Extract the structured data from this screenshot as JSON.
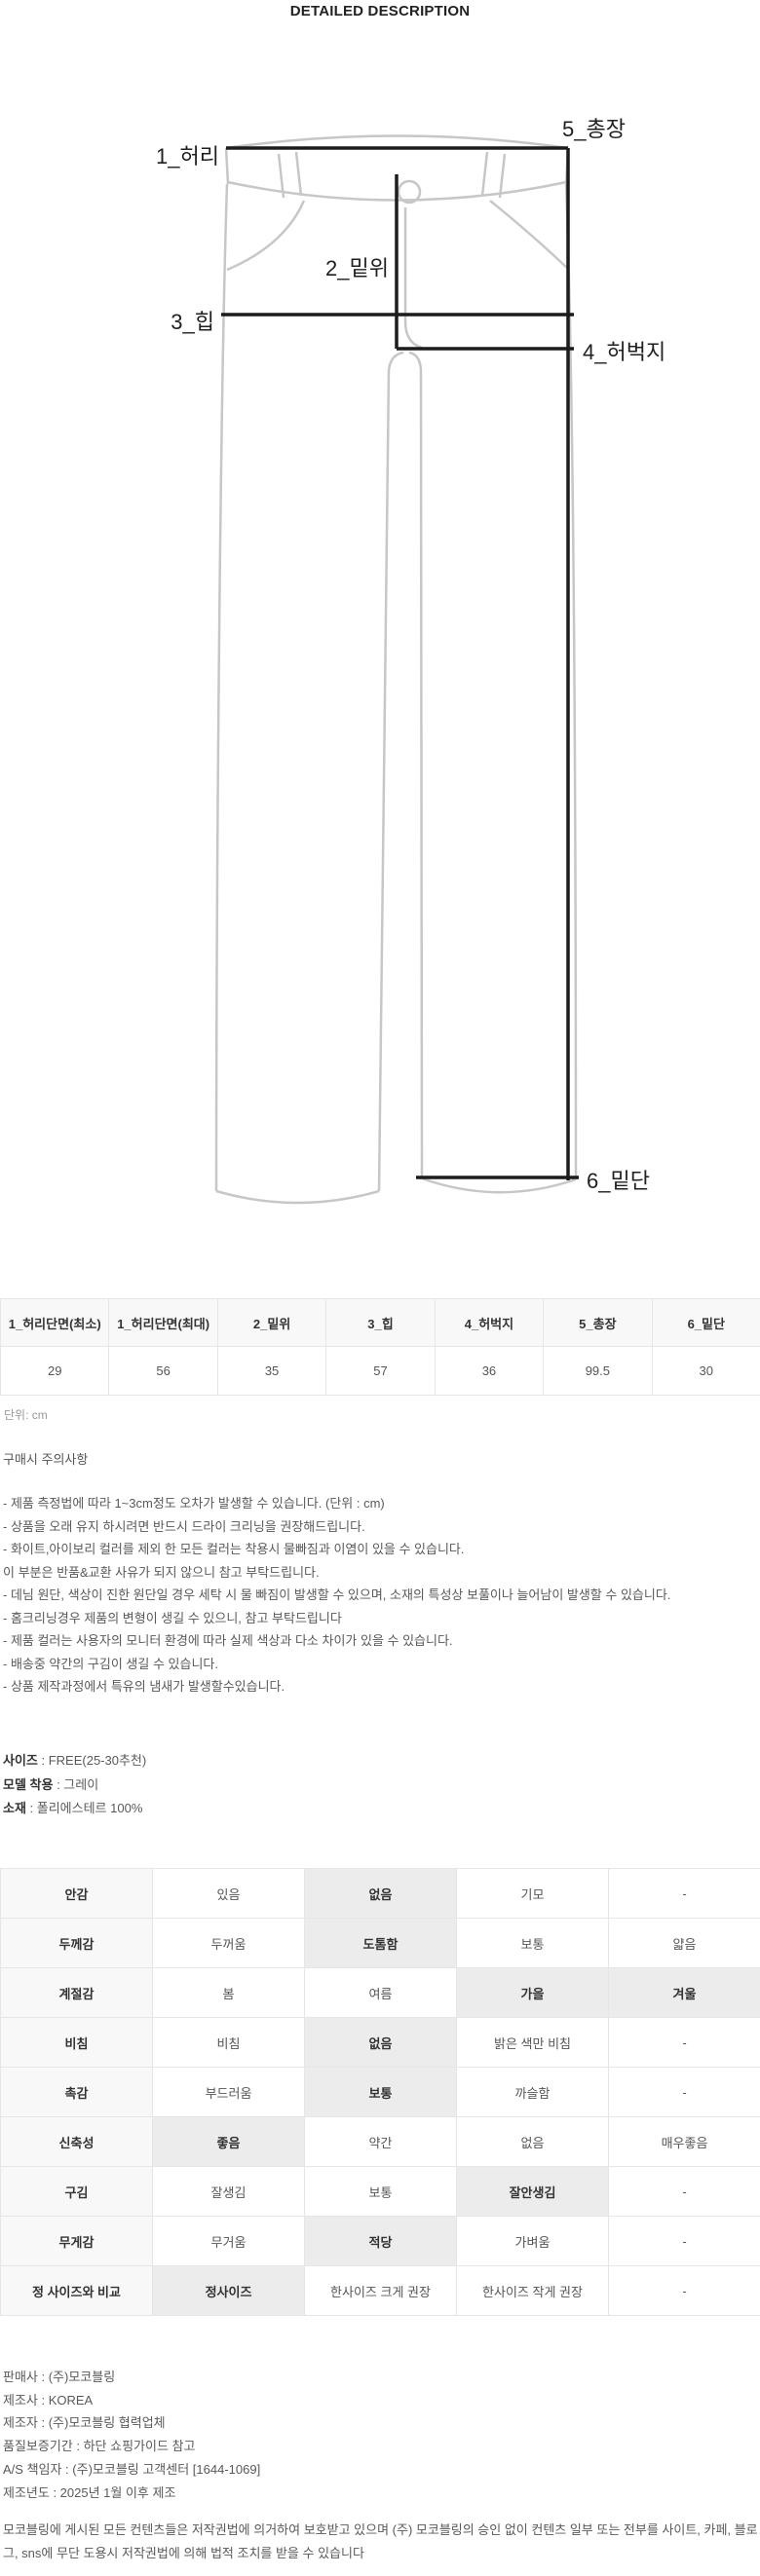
{
  "page_title": "DETAILED DESCRIPTION",
  "diagram": {
    "labels": {
      "waist": "1_허리",
      "rise": "2_밑위",
      "hip": "3_힙",
      "thigh": "4_허벅지",
      "total_length": "5_총장",
      "hem": "6_밑단"
    }
  },
  "size_table": {
    "headers": [
      "1_허리단면(최소)",
      "1_허리단면(최대)",
      "2_밑위",
      "3_힙",
      "4_허벅지",
      "5_총장",
      "6_밑단"
    ],
    "values": [
      "29",
      "56",
      "35",
      "57",
      "36",
      "99.5",
      "30"
    ],
    "unit_note": "단위: cm"
  },
  "notice": {
    "heading": "구매시 주의사항",
    "lines": [
      "- 제품 측정법에 따라 1~3cm정도 오차가 발생할 수 있습니다. (단위 : cm)",
      "- 상품을 오래 유지 하시려면 반드시 드라이 크리닝을 권장해드립니다.",
      "- 화이트,아이보리 컬러를 제외 한 모든 컬러는 착용시 물빠짐과 이염이 있을 수 있습니다.",
      "이 부분은 반품&교환 사유가 되지 않으니 참고 부탁드립니다.",
      "- 데님 원단, 색상이 진한 원단일 경우 세탁 시 물 빠짐이 발생할 수 있으며, 소재의 특성상 보풀이나 늘어남이 발생할 수 있습니다.",
      "- 홈크리닝경우 제품의 변형이 생길 수 있으니, 참고 부탁드립니다",
      "- 제품 컬러는 사용자의 모니터 환경에 따라 실제 색상과 다소 차이가 있을 수 있습니다.",
      "- 배송중 약간의 구김이 생길 수 있습니다.",
      "- 상품 제작과정에서 특유의 냄새가 발생할수있습니다."
    ]
  },
  "product_info": [
    {
      "label": "사이즈",
      "value": " : FREE(25-30추천)"
    },
    {
      "label": "모델 착용",
      "value": " : 그레이"
    },
    {
      "label": "소재",
      "value": " : 폴리에스테르 100%"
    }
  ],
  "fabric_table": {
    "rows": [
      {
        "label": "안감",
        "options": [
          "있음",
          "없음",
          "기모",
          "-"
        ],
        "selected": [
          1
        ]
      },
      {
        "label": "두께감",
        "options": [
          "두꺼움",
          "도톰함",
          "보통",
          "얇음"
        ],
        "selected": [
          1
        ]
      },
      {
        "label": "계절감",
        "options": [
          "봄",
          "여름",
          "가을",
          "겨울"
        ],
        "selected": [
          2,
          3
        ]
      },
      {
        "label": "비침",
        "options": [
          "비침",
          "없음",
          "밝은 색만 비침",
          "-"
        ],
        "selected": [
          1
        ]
      },
      {
        "label": "촉감",
        "options": [
          "부드러움",
          "보통",
          "까슬함",
          "-"
        ],
        "selected": [
          1
        ]
      },
      {
        "label": "신축성",
        "options": [
          "좋음",
          "약간",
          "없음",
          "매우좋음"
        ],
        "selected": [
          0
        ]
      },
      {
        "label": "구김",
        "options": [
          "잘생김",
          "보통",
          "잘안생김",
          "-"
        ],
        "selected": [
          2
        ]
      },
      {
        "label": "무게감",
        "options": [
          "무거움",
          "적당",
          "가벼움",
          "-"
        ],
        "selected": [
          1
        ]
      },
      {
        "label": "정 사이즈와 비교",
        "options": [
          "정사이즈",
          "한사이즈 크게 권장",
          "한사이즈 작게 권장",
          "-"
        ],
        "selected": [
          0
        ]
      }
    ]
  },
  "seller_info": {
    "lines": [
      "판매사 : (주)모코블링",
      "제조사 : KOREA",
      "제조자 : (주)모코블링 협력업체",
      "품질보증기간 : 하단 쇼핑가이드 참고",
      "A/S 책임자 : (주)모코블링 고객센터 [1644-1069]",
      "제조년도 : 2025년 1월 이후 제조"
    ],
    "copyright": "모코블링에 게시된 모든 컨텐츠들은 저작권법에 의거하여 보호받고 있으며 (주) 모코블링의 승인 없이 컨텐츠 일부 또는 전부를 사이트, 카페, 블로그, sns에 무단 도용시 저작권법에 의해 법적 조치를 받을 수 있습니다"
  },
  "colors": {
    "table_header_bg": "#f8f8f8",
    "highlight_bg": "#ececec",
    "border": "#e6e6e6",
    "outline_gray": "#c7c7c7",
    "measure_line": "#1c1c1c",
    "text_dark": "#333333",
    "text_body": "#595959"
  }
}
